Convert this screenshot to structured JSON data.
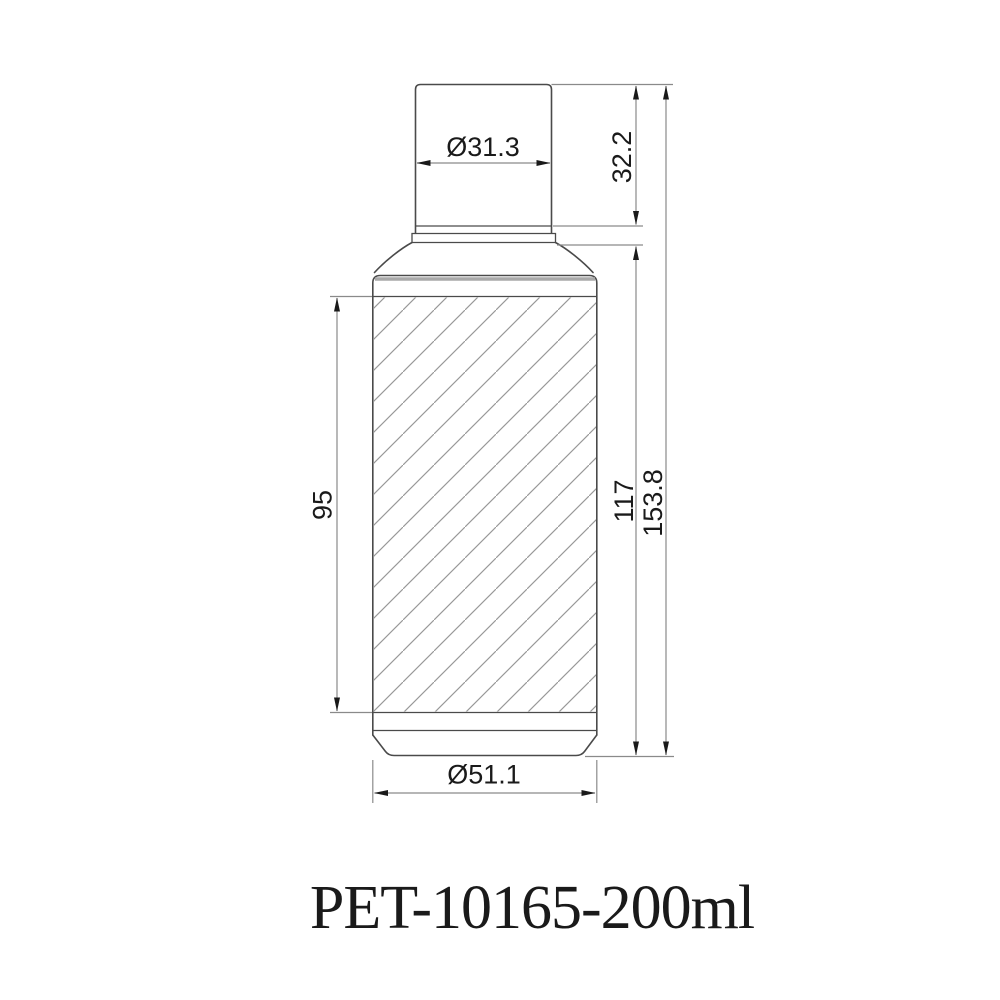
{
  "drawing": {
    "title": "PET-10165-200ml",
    "dimensions": {
      "neck_diameter": "Ø31.3",
      "neck_height": "32.2",
      "label_panel_height": "95",
      "body_height": "117",
      "total_height": "153.8",
      "base_diameter": "Ø51.1"
    }
  },
  "colors": {
    "background": "#ffffff",
    "outline": "#4a4a4a",
    "band": "#a9a9a9",
    "dimension": "#8a8a8a",
    "hatch": "#979797",
    "arrow": "#1a1a1a",
    "text": "#1a1a1a"
  }
}
